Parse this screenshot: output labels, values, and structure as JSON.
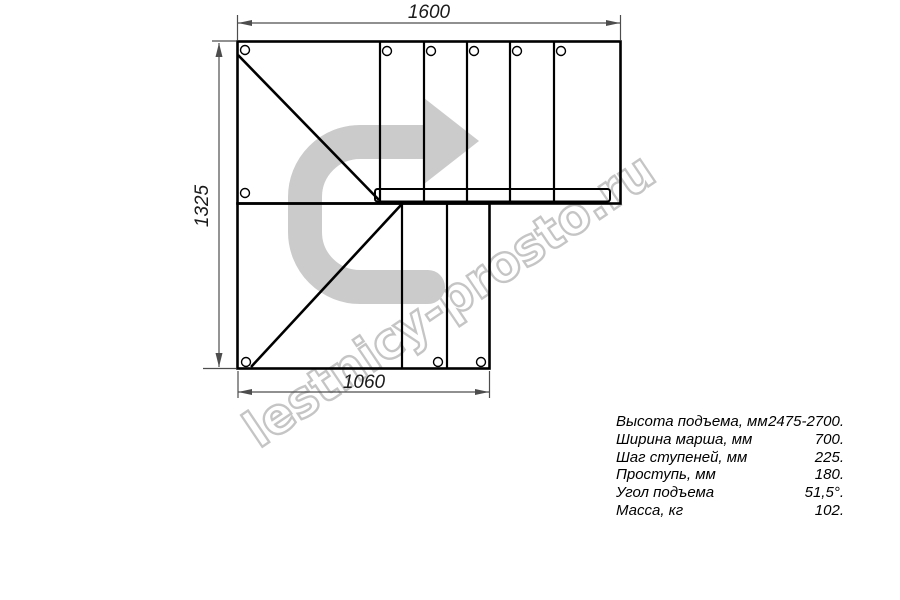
{
  "drawing": {
    "title": "L-turn staircase plan view",
    "watermark": {
      "text": "lestnicy-prosto.ru",
      "outline_color": "#c5c5c5"
    },
    "direction_arrow": {
      "meaning": "walk direction, 180-degree turn to the right",
      "color": "#cbcbcb"
    },
    "dimensions": {
      "top_width": "1600",
      "left_height": "1325",
      "bottom_width": "1060"
    },
    "colors": {
      "outline": "#000000",
      "dimension_lines": "#4d4d4d",
      "background": "#ffffff"
    }
  },
  "specs": {
    "rows": [
      {
        "label": "Высота подъема, мм",
        "value": "2475-2700."
      },
      {
        "label": "Ширина марша, мм",
        "value": "700."
      },
      {
        "label": "Шаг ступеней, мм",
        "value": "225."
      },
      {
        "label": "Проступь, мм",
        "value": "180."
      },
      {
        "label": "Угол подъема",
        "value": "51,5°."
      },
      {
        "label": "Масса, кг",
        "value": "102."
      }
    ]
  }
}
